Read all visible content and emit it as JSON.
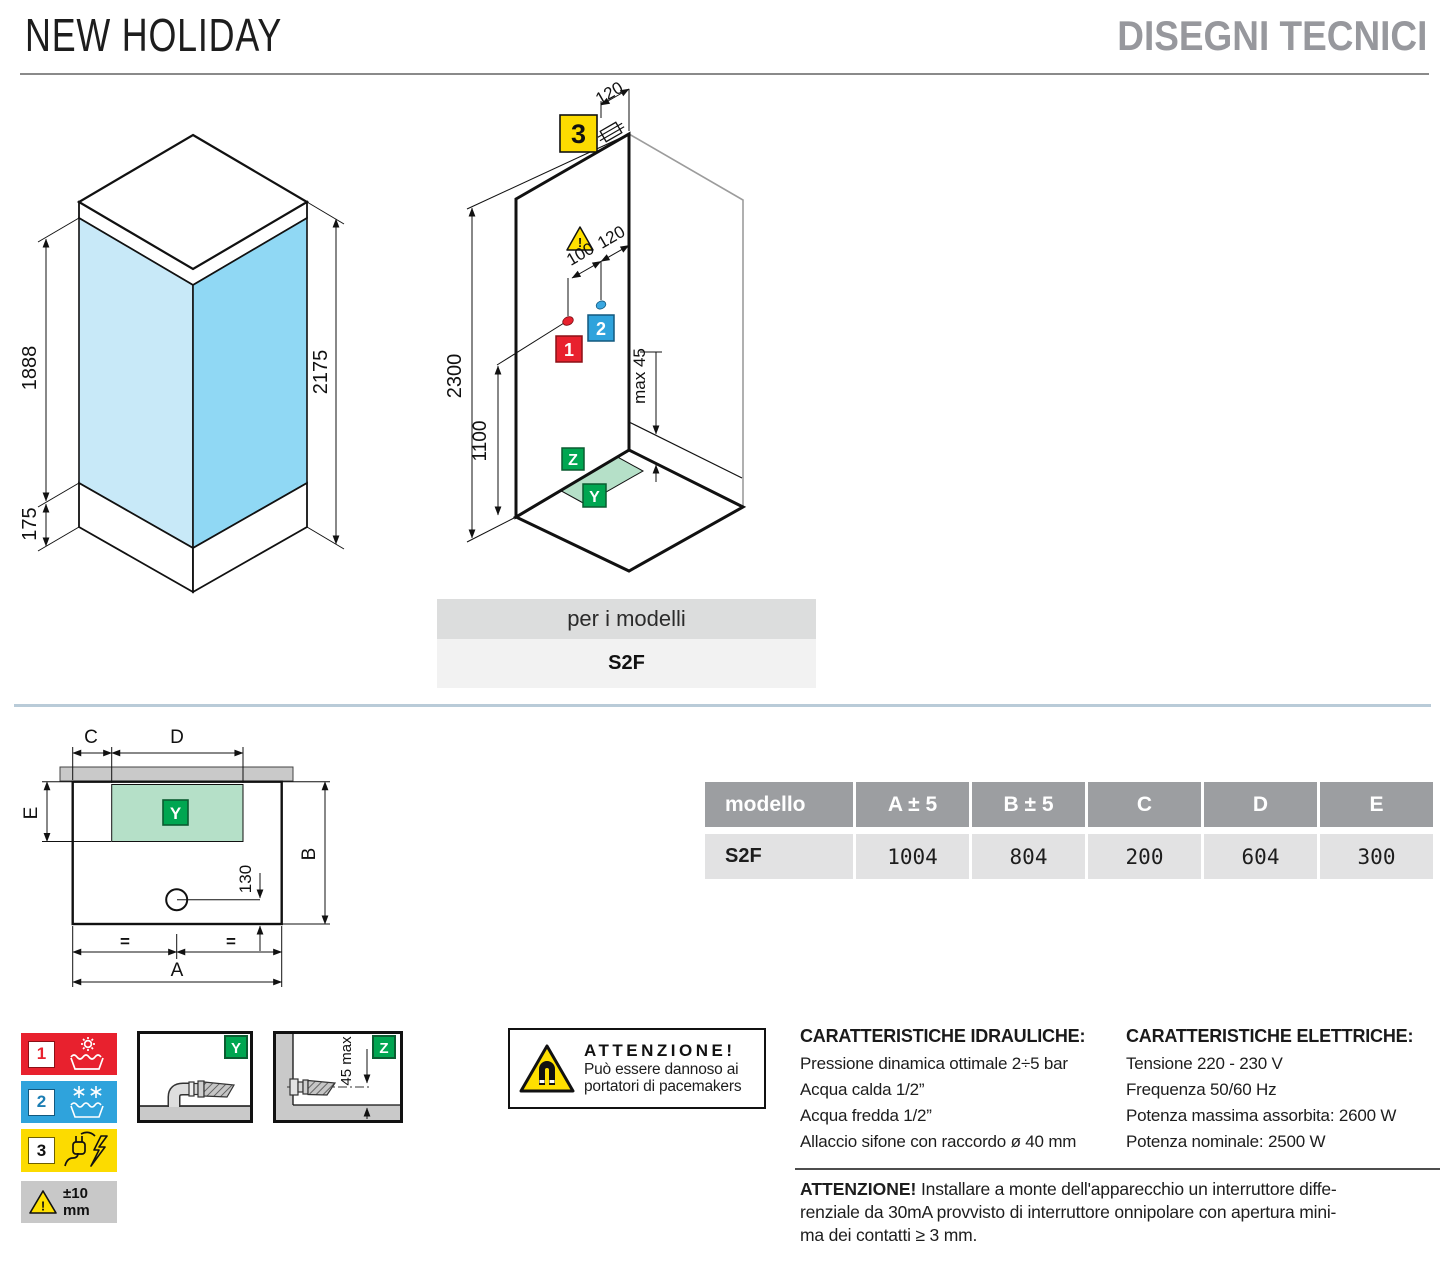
{
  "header": {
    "title": "NEW HOLIDAY",
    "section": "DISEGNI TECNICI"
  },
  "iso_view": {
    "glass_height": "1888",
    "tray_height": "175",
    "total_height": "2175"
  },
  "install_view": {
    "electric_badge": "3",
    "hot_badge": "1",
    "cold_badge": "2",
    "wall_zone_badge": "Z",
    "floor_zone_badge": "Y",
    "dim_electric_offset": "120",
    "dim_hot_cold_gap": "100",
    "dim_cold_offset": "120",
    "dim_wall_height": "2300",
    "dim_outlet_height": "1100",
    "dim_drain_max": "max 45",
    "warning_mark": "!"
  },
  "models_box": {
    "label": "per i modelli",
    "model": "S2F"
  },
  "plan_view": {
    "dim_a": "A",
    "dim_b": "B",
    "dim_c": "C",
    "dim_d": "D",
    "dim_e": "E",
    "dim_drain": "130",
    "equal_left": "=",
    "equal_right": "=",
    "zone_badge": "Y"
  },
  "size_table": {
    "headers": [
      "modello",
      "A ± 5",
      "B ± 5",
      "C",
      "D",
      "E"
    ],
    "row": {
      "model": "S2F",
      "values": [
        "1004",
        "804",
        "200",
        "604",
        "300"
      ]
    }
  },
  "legend": {
    "hot_num": "1",
    "cold_num": "2",
    "electric_num": "3",
    "tolerance": "±10 mm",
    "tolerance_mark": "!"
  },
  "detail_y": {
    "badge": "Y"
  },
  "detail_z": {
    "badge": "Z",
    "dim": "45 max"
  },
  "magnet_warning": {
    "title": "ATTENZIONE!",
    "line1": "Può essere dannoso ai",
    "line2": "portatori di pacemakers"
  },
  "hydraulics": {
    "title": "CARATTERISTICHE IDRAULICHE:",
    "lines": [
      "Pressione dinamica ottimale 2÷5 bar",
      "Acqua calda 1/2”",
      "Acqua fredda 1/2”",
      "Allaccio sifone con raccordo ø 40 mm"
    ]
  },
  "electrics": {
    "title": "CARATTERISTICHE ELETTRICHE:",
    "lines": [
      "Tensione 220 - 230 V",
      "Frequenza 50/60 Hz",
      "Potenza massima assorbita: 2600 W",
      "Potenza nominale: 2500 W"
    ]
  },
  "footer_warning": {
    "bold": "ATTENZIONE!",
    "line1": " Installare a monte dell'apparecchio un interruttore diffe-",
    "line2": "renziale da 30mA provvisto di interruttore onnipolare con apertura mini-",
    "line3": "ma dei contatti ≥ 3 mm."
  },
  "colors": {
    "hot_red": "#e8212e",
    "cold_blue": "#2fa3dc",
    "electric_yellow": "#fcdb00",
    "zone_green": "#00a651",
    "glass_light": "#c8e9f8",
    "glass_dark": "#90d8f4",
    "table_header_gray": "#9c9ea1",
    "divider_blue": "#b9cbd8"
  }
}
